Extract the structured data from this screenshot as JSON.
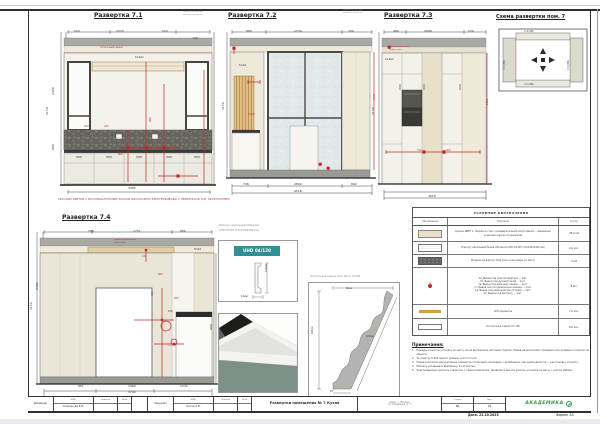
{
  "colors": {
    "accent_red": "#C1272D",
    "band_gray": "#A9A8A3",
    "wall_beige": "#EFE9DA",
    "glass": "#E3EAEB",
    "mosaic": "#6C6C68",
    "wood": "#E2C08C",
    "led": "#D89B43",
    "logo_green": "#2F9E44",
    "teal_chip": "#2E8F94"
  },
  "titles": {
    "e71": "Развертка 7.1",
    "e72": "Развертка 7.2",
    "e73": "Развертка 7.3",
    "e74": "Развертка 7.4",
    "scheme": "Схема развертки пом. 7"
  },
  "red_note": "КРАСНЫМ ЦВЕТОМ С ВОСКЛИЦАТЕЛЬНЫМ ЗНАКОМ ОБОЗНАЧЕНЫ ЭЛЕКТРОВЫВОДЫ С ПРИВЯЗКАМИ (СМ. ОБОЗНАЧЕНИЯ)",
  "scheme": {
    "top": "7.4 (2В)",
    "bottom": "7.2 (2В)",
    "left": "7.1 (2В)",
    "right": "7.3 (2В)"
  },
  "details": {
    "plinth_caption_1": "Плинтус напольный Ultrawood",
    "plinth_caption_2": "UHD 04/120 (14х120х2440 мм)",
    "plinth_chip": "UHD 04/120",
    "cornice_caption": "Потолочный карниз Orac Decor CX106"
  },
  "legend": {
    "title": "УСЛОВНЫЕ ОБОЗНАЧЕНИЯ",
    "col_symbol": "Обозначение",
    "col_desc": "Описание",
    "col_qty": "кол-во",
    "rows": [
      {
        "swatch": "paint",
        "desc": "Краска ЦВЕТ 1: Покраска стен с предварительной подготовкой — финишная колеровка краски по выкрасам",
        "qty": "35,4 м2"
      },
      {
        "swatch": "plinth",
        "desc": "Плинтус напольный белый Ultrawood UHD 04/120 (14х120х2440 мм)",
        "qty": "4,2 м.п."
      },
      {
        "swatch": "mosaic",
        "desc": "Мозаика на фартук. Вид узла и раскладка по месту",
        "qty": "2 м2"
      },
      {
        "swatch": "socket",
        "desc": "1а. Вывод под розетки фартука — 3шт.\n1б. Вывод под духовой шкаф — 1шт.\n1в. Вывод под варочную панель — 1шт.\n1г. Вывод под посудомоечную машину — 1шт.\n1д. Вывод под измельчитель отходов — 1шт.\n1е. Вывод под вытяжку — 1шт.",
        "qty": "8 шт."
      },
      {
        "swatch": "led",
        "desc": "LED подсветка",
        "qty": "7,0 м.п."
      },
      {
        "swatch": "cornice",
        "desc": "Потолочный карниз CX 106",
        "qty": "8,0 м.п."
      }
    ]
  },
  "notes": {
    "title": "Примечания:",
    "items": [
      "Размеры и высоты уточнять по месту после выполнения чистовой отделки. Перед началом работ проверить все размеры и отметки на объекте.",
      "За отметку 0,000 принят уровень чистого пола.",
      "Перед монтажом декоративных элементов согласовать раскладку с дизайнером, при необходимости — расстановку по месту.",
      "Мозаику укладывать вразбежку, в 1/2 плитки.",
      "Электровыводы смотреть совместно с планом электрики. Привязки и высоты розеток уточнять по месту с учётом мебели."
    ]
  },
  "titleblock": {
    "designer_label": "Дизайнер",
    "designer_name": "Капранова Е.В.",
    "fio": "ФИО",
    "sign": "Подпись",
    "date": "Дата",
    "client_label": "Заказчик",
    "client_name": "Котов А.В.",
    "sheet_title": "Развертки помещения № 7 Кухня",
    "address_1": "Адрес: г. Москва,",
    "address_2": "ул. Академика, д. 7",
    "stage_label": "Стадия",
    "stage_value": "РД",
    "list_label": "Лист",
    "list_value": "28",
    "logo": "АКАДЕМИКА",
    "date_value": "Дата: 22.10.2023",
    "format": "Формат А3"
  },
  "labels": [
    {
      "x": 74,
      "y": 30,
      "t": "520"
    },
    {
      "x": 116,
      "y": 30,
      "t": "2370"
    },
    {
      "x": 162,
      "y": 30,
      "t": "520"
    },
    {
      "x": 193,
      "y": 38,
      "t": "190",
      "s": 2.4
    },
    {
      "x": 128,
      "y": 187,
      "t": "3485"
    },
    {
      "x": 46,
      "y": 115,
      "t": "3150",
      "r": 1
    },
    {
      "x": 52,
      "y": 95,
      "t": "2400",
      "r": 1
    },
    {
      "x": 52,
      "y": 150,
      "t": "900",
      "r": 1
    },
    {
      "x": 135,
      "y": 57,
      "t": "15,2м2",
      "s": 2.4
    },
    {
      "x": 100,
      "y": 47,
      "t": "потолочный карниз",
      "c": "r",
      "s": 2.2
    },
    {
      "x": 84,
      "y": 126,
      "t": "560",
      "c": "r",
      "s": 2.4
    },
    {
      "x": 104,
      "y": 126,
      "t": "450",
      "c": "r",
      "s": 2.4
    },
    {
      "x": 150,
      "y": 122,
      "t": "900",
      "c": "r",
      "r": 1,
      "s": 2.4
    },
    {
      "x": 118,
      "y": 154,
      "t": "600",
      "c": "r",
      "s": 2.4
    },
    {
      "x": 183,
      "y": 11,
      "t": "Ниша (см. деталь)",
      "c": "g",
      "s": 2.1
    },
    {
      "x": 183,
      "y": 14,
      "t": "монтаж по месту",
      "c": "g",
      "s": 2.1
    },
    {
      "x": 246,
      "y": 30,
      "t": "880"
    },
    {
      "x": 294,
      "y": 30,
      "t": "1730"
    },
    {
      "x": 348,
      "y": 30,
      "t": "700"
    },
    {
      "x": 243,
      "y": 183,
      "t": "736"
    },
    {
      "x": 294,
      "y": 183,
      "t": "2890"
    },
    {
      "x": 351,
      "y": 183,
      "t": "892"
    },
    {
      "x": 294,
      "y": 190,
      "t": "4518"
    },
    {
      "x": 222,
      "y": 110,
      "t": "3150",
      "r": 1
    },
    {
      "x": 239,
      "y": 65,
      "t": "5,5м2",
      "s": 2.4
    },
    {
      "x": 374,
      "y": 100,
      "t": "2740",
      "c": "r",
      "r": 1,
      "s": 2.4
    },
    {
      "x": 248,
      "y": 114,
      "t": "40х40",
      "c": "r",
      "s": 2.2
    },
    {
      "x": 343,
      "y": 9,
      "t": "Ниша (см. деталь)",
      "c": "g",
      "s": 2.1
    },
    {
      "x": 343,
      "y": 12,
      "t": "монтаж по месту",
      "c": "g",
      "s": 2.1
    },
    {
      "x": 393,
      "y": 30,
      "t": "480"
    },
    {
      "x": 424,
      "y": 30,
      "t": "2098"
    },
    {
      "x": 468,
      "y": 30,
      "t": "520"
    },
    {
      "x": 428,
      "y": 195,
      "t": "3619"
    },
    {
      "x": 372,
      "y": 115,
      "t": "3150",
      "r": 1
    },
    {
      "x": 417,
      "y": 150,
      "t": "720",
      "c": "r",
      "s": 2.4
    },
    {
      "x": 446,
      "y": 150,
      "t": "600",
      "c": "r",
      "s": 2.4
    },
    {
      "x": 487,
      "y": 105,
      "t": "2620",
      "c": "r",
      "r": 1,
      "s": 2.4
    },
    {
      "x": 389,
      "y": 46,
      "t": "карниз крашеный",
      "c": "r",
      "s": 2.1
    },
    {
      "x": 389,
      "y": 49,
      "t": "в цвет стен",
      "c": "r",
      "s": 2.1
    },
    {
      "x": 385,
      "y": 59,
      "t": "12,9м2",
      "s": 2.4
    },
    {
      "x": 88,
      "y": 230,
      "t": "758"
    },
    {
      "x": 133,
      "y": 230,
      "t": "1751"
    },
    {
      "x": 180,
      "y": 230,
      "t": "866"
    },
    {
      "x": 78,
      "y": 385,
      "t": "851"
    },
    {
      "x": 128,
      "y": 385,
      "t": "1460"
    },
    {
      "x": 180,
      "y": 385,
      "t": "1534"
    },
    {
      "x": 128,
      "y": 391,
      "t": "3790"
    },
    {
      "x": 30,
      "y": 310,
      "t": "3150",
      "r": 1
    },
    {
      "x": 36,
      "y": 290,
      "t": "2400",
      "r": 1
    },
    {
      "x": 210,
      "y": 330,
      "t": "900",
      "r": 1
    },
    {
      "x": 152,
      "y": 296,
      "t": "700",
      "c": "r",
      "r": 1,
      "s": 2.4
    },
    {
      "x": 158,
      "y": 274,
      "t": "400",
      "c": "r",
      "s": 2.4
    },
    {
      "x": 142,
      "y": 256,
      "t": "120",
      "c": "r",
      "s": 2.4
    },
    {
      "x": 174,
      "y": 298,
      "t": "450",
      "c": "r",
      "s": 2.4
    },
    {
      "x": 114,
      "y": 239,
      "t": "карниз деревянный",
      "c": "r",
      "s": 2.1
    },
    {
      "x": 114,
      "y": 242,
      "t": "крашеный",
      "c": "r",
      "s": 2.1
    },
    {
      "x": 194,
      "y": 249,
      "t": "8,5м2",
      "s": 2.4
    },
    {
      "x": 168,
      "y": 345,
      "t": "выключ.",
      "c": "g",
      "s": 2.1
    },
    {
      "x": 168,
      "y": 311,
      "t": "670",
      "s": 2.4
    },
    {
      "x": 266,
      "y": 272,
      "t": "120мм",
      "r": 1,
      "s": 2.4
    },
    {
      "x": 241,
      "y": 296,
      "t": "14мм",
      "s": 2.4
    },
    {
      "x": 346,
      "y": 288,
      "t": "60мм",
      "s": 2.2
    },
    {
      "x": 312,
      "y": 334,
      "t": "106мм",
      "r": 1,
      "s": 2.2
    },
    {
      "x": 366,
      "y": 336,
      "t": "163мм",
      "s": 2.2
    },
    {
      "x": 330,
      "y": 391,
      "t": "45°",
      "s": 2.2
    }
  ]
}
